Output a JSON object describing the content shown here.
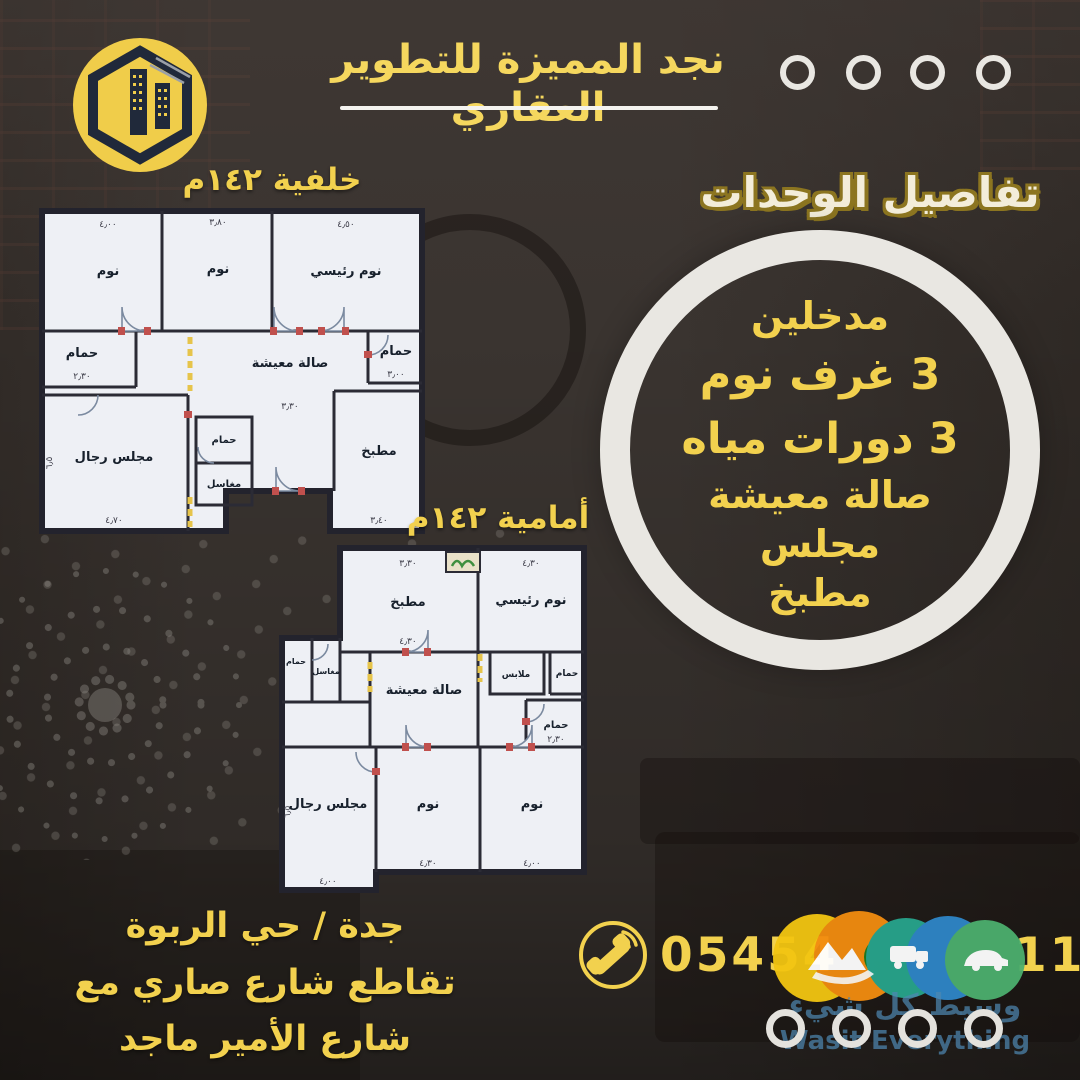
{
  "header": {
    "company_title": "نجد المميزة للتطوير العقاري",
    "logo_name": "najd-development-logo"
  },
  "units": {
    "section_title": "تفاصيل الوحدات",
    "features": [
      "مدخلين",
      "3 غرف نوم",
      "3 دورات مياه",
      "صالة معيشة",
      "مجلس",
      "مطبخ"
    ]
  },
  "plans": {
    "back": {
      "label": "خلفية ١٤٢م",
      "rooms": {
        "bed1": "نوم",
        "bed2": "نوم",
        "master": "نوم رئيسي",
        "bath1": "حمام",
        "living": "صالة معيشة",
        "bath2": "حمام",
        "majlis": "مجلس رجال",
        "bath3": "حمام",
        "sinks": "مغاسل",
        "kitchen": "مطبخ"
      },
      "dims": {
        "bed1": "٤٫٠٠",
        "bed2": "٣٫٨٠",
        "master": "٤٫٥٠",
        "bath1": "٢٫٣٠",
        "bath2": "٣٫٠٠",
        "living": "٣٫٣٠",
        "majlis": "٤٫٧٠",
        "majlis_h": "٦٫٥",
        "kitchen": "٣٫٤٠"
      }
    },
    "front": {
      "label": "أمامية ١٤٢م",
      "rooms": {
        "kitchen": "مطبخ",
        "master": "نوم رئيسي",
        "living": "صالة معيشة",
        "closet": "ملابس",
        "bath1": "حمام",
        "bath2": "حمام",
        "bath3": "حمام",
        "sinks": "مغاسل",
        "majlis": "مجلس رجال",
        "bed1": "نوم",
        "bed2": "نوم"
      },
      "dims": {
        "kitchen": "٣٫٣٠",
        "kitchen_b": "٤٫٣٠",
        "master": "٤٫٣٠",
        "bath2": "٢٫٣٠",
        "majlis": "٤٫٠٠",
        "majlis_h": "٦٫٥",
        "bed1": "٤٫٣٠",
        "bed2": "٤٫٠٠"
      }
    }
  },
  "location": {
    "lines": [
      "جدة / حي الربوة",
      "تقاطع شارع صاري مع",
      "شارع الأمير ماجد"
    ]
  },
  "contact": {
    "phone_visible_start": "05454",
    "phone_visible_end": "11"
  },
  "watermark": {
    "arabic": "وسيط كل شيء",
    "english": "Wasit Everything"
  },
  "colors": {
    "accent_yellow": "#f2d14e",
    "cream": "#f3edda",
    "outline_gold": "#8c7520",
    "ring_white": "#e9e7e2",
    "watermark_blue": "#4e86b0"
  }
}
